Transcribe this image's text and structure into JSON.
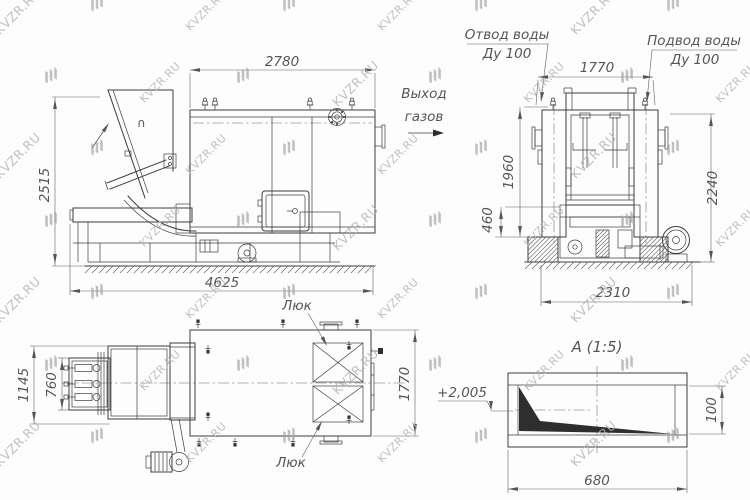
{
  "watermark": {
    "text": "KVZR.RU"
  },
  "side_view": {
    "dim_top": "2780",
    "dim_left": "2515",
    "dim_bottom": "4625",
    "hopper_mark": "∩"
  },
  "front_view": {
    "water_outlet_l1": "Отвод воды",
    "water_outlet_l2": "Ду 100",
    "water_inlet_l1": "Подвод воды",
    "water_inlet_l2": "Ду 100",
    "gas_exit_l1": "Выход",
    "gas_exit_l2": "газов",
    "dim_top": "1770",
    "dim_left_outer": "1960",
    "dim_left_inner": "460",
    "dim_right": "2240",
    "dim_bottom": "2310"
  },
  "plan_view": {
    "hatch_top": "Люк",
    "hatch_bottom": "Люк",
    "dim_left_outer": "1145",
    "dim_left_inner": "760",
    "dim_right": "1770"
  },
  "detail_view": {
    "title": "А (1:5)",
    "elevation": "+2,005",
    "dim_bottom": "680",
    "dim_right": "100"
  }
}
